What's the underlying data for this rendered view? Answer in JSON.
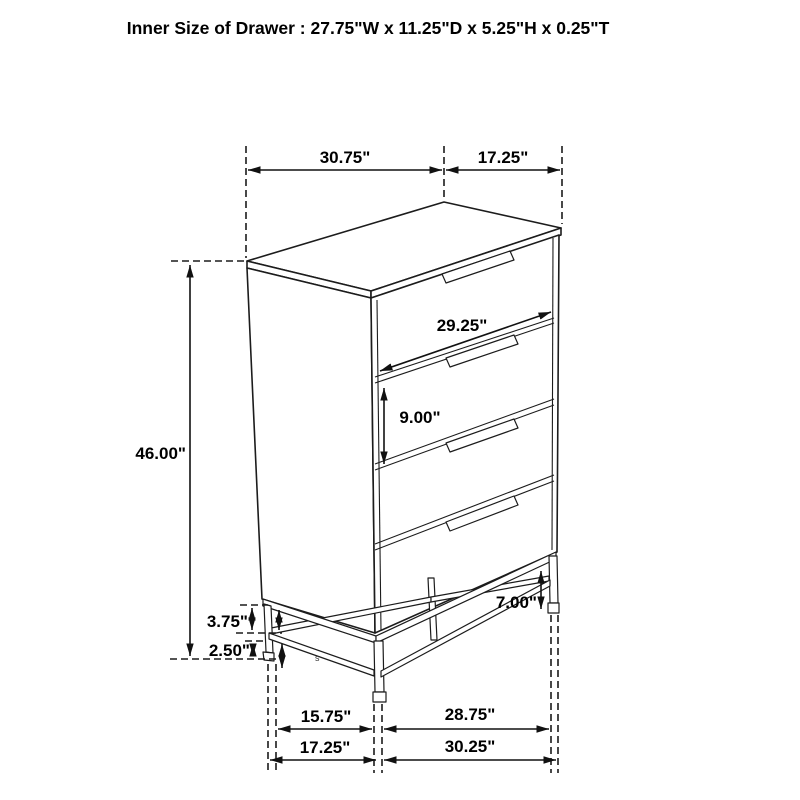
{
  "title": "Inner Size of Drawer : 27.75\"W x 11.25\"D x 5.25\"H x 0.25\"T",
  "dimensions": {
    "top_width": "30.75\"",
    "top_depth": "17.25\"",
    "drawer_face_width": "29.25\"",
    "drawer_face_height": "9.00\"",
    "overall_height": "46.00\"",
    "base_rail_gap": "3.75\"",
    "base_floor_clearance": "2.50\"",
    "leg_height": "7.00\"",
    "base_inner_depth": "15.75\"",
    "base_inner_width": "28.75\"",
    "base_outer_depth": "17.25\"",
    "base_outer_width": "30.25\""
  },
  "part_mark": "s",
  "colors": {
    "line": "#1c1c1c",
    "text": "#000000",
    "background": "#ffffff"
  }
}
